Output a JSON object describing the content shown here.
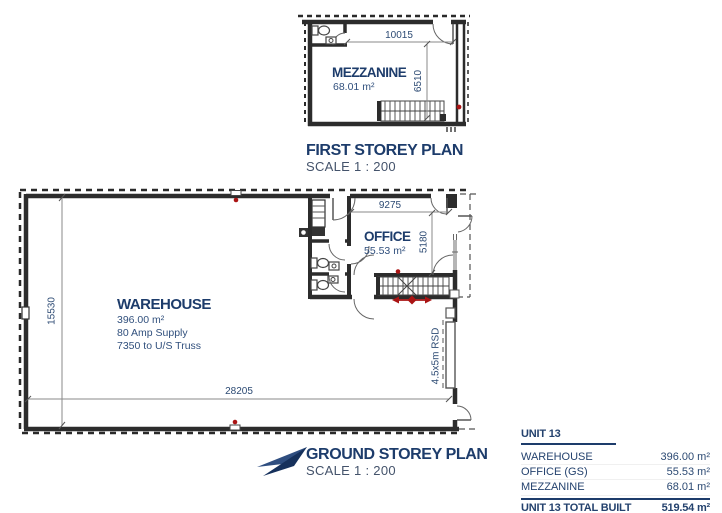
{
  "first_storey": {
    "title": "FIRST STOREY PLAN",
    "scale": "SCALE 1 : 200",
    "room": {
      "name": "MEZZANINE",
      "area": "68.01 m²"
    },
    "dims": {
      "width": "10015",
      "height": "6510"
    }
  },
  "ground_storey": {
    "title": "GROUND STOREY PLAN",
    "scale": "SCALE 1 : 200",
    "warehouse": {
      "name": "WAREHOUSE",
      "area": "396.00 m²",
      "supply": "80 Amp Supply",
      "truss": "7350 to U/S Truss"
    },
    "office": {
      "name": "OFFICE",
      "area": "55.53 m²"
    },
    "dims": {
      "overall_width": "28205",
      "overall_height": "15530",
      "office_width": "9275",
      "office_height": "5180"
    },
    "rsd_label": "4.5x5m RSD"
  },
  "summary_table": {
    "header": "UNIT 13",
    "rows": [
      {
        "label": "WAREHOUSE",
        "value": "396.00 m²"
      },
      {
        "label": "OFFICE (GS)",
        "value": "55.53 m²"
      },
      {
        "label": "MEZZANINE",
        "value": "68.01 m²"
      }
    ],
    "total": {
      "label": "UNIT 13 TOTAL BUILT",
      "value": "519.54 m²"
    }
  },
  "colors": {
    "navy": "#1d3c6b",
    "red": "#aa1414",
    "wall": "#2c2c2c"
  }
}
